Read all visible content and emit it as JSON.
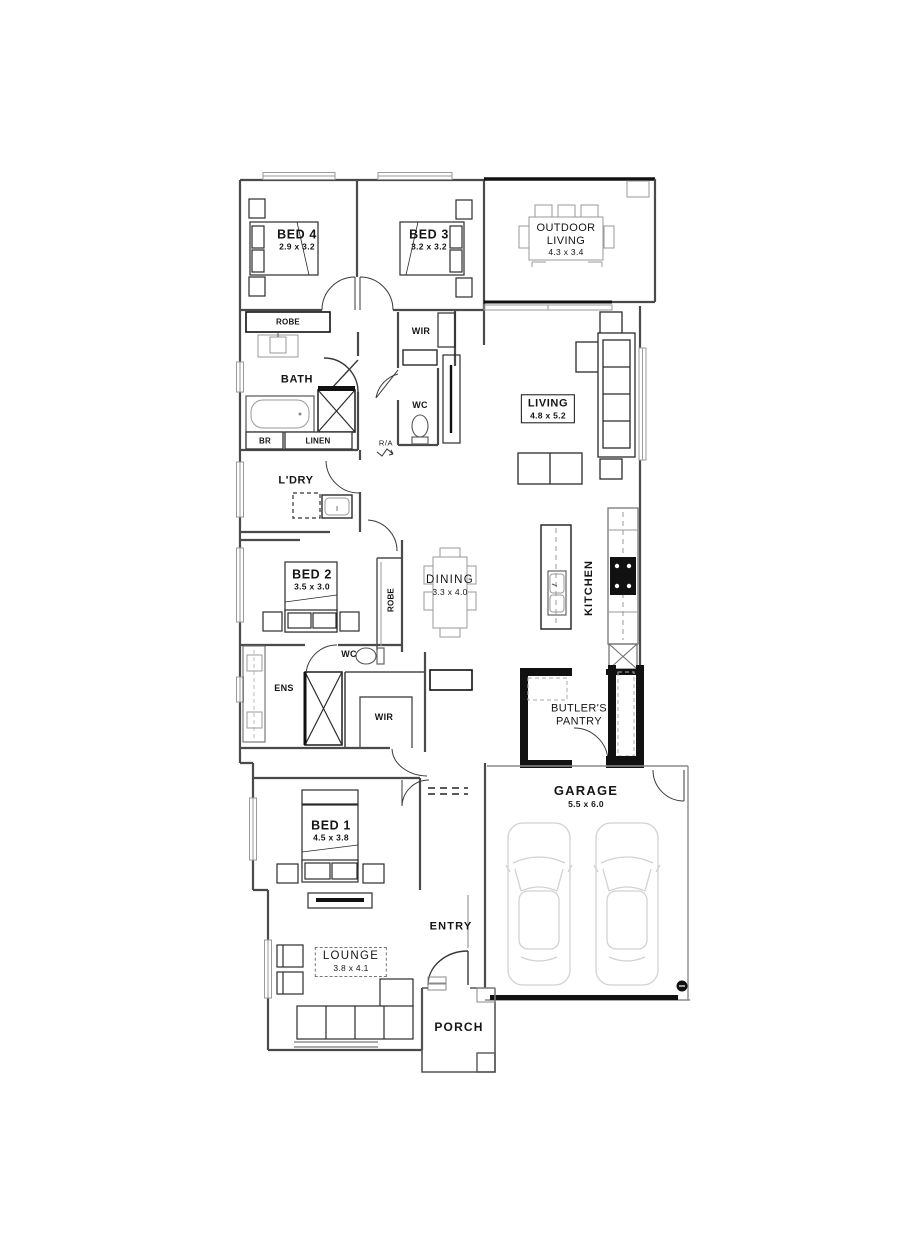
{
  "rooms": {
    "bed4": {
      "label": "BED 4",
      "dims": "2.9 x 3.2"
    },
    "bed3": {
      "label": "BED 3",
      "dims": "3.2 x 3.2"
    },
    "outdoor_living": {
      "label": "OUTDOOR LIVING",
      "dims": "4.3 x 3.4"
    },
    "robe_bed4": {
      "label": "ROBE"
    },
    "wir_hall": {
      "label": "WIR"
    },
    "bath": {
      "label": "BATH"
    },
    "wc_hall": {
      "label": "WC"
    },
    "br": {
      "label": "BR"
    },
    "linen": {
      "label": "LINEN"
    },
    "ra": {
      "label": "R/A"
    },
    "living": {
      "label": "LIVING",
      "dims": "4.8 x 5.2"
    },
    "ldry": {
      "label": "L'DRY"
    },
    "bed2": {
      "label": "BED 2",
      "dims": "3.5 x 3.0"
    },
    "robe_bed2": {
      "label": "ROBE"
    },
    "dining": {
      "label": "DINING",
      "dims": "3.3 x 4.0"
    },
    "kitchen": {
      "label": "KITCHEN"
    },
    "wc_ens": {
      "label": "WC"
    },
    "ens": {
      "label": "ENS"
    },
    "wir_master": {
      "label": "WIR"
    },
    "butlers_pantry": {
      "label": "BUTLER'S PANTRY"
    },
    "garage": {
      "label": "GARAGE",
      "dims": "5.5 x 6.0"
    },
    "bed1": {
      "label": "BED 1",
      "dims": "4.5 x 3.8"
    },
    "entry": {
      "label": "ENTRY"
    },
    "lounge": {
      "label": "LOUNGE",
      "dims": "3.8 x 4.1"
    },
    "porch": {
      "label": "PORCH"
    }
  },
  "colors": {
    "ink": "#151515",
    "wall": "#4a4a4a",
    "light_line": "#9a9a9a",
    "faint": "#cfcfcf"
  }
}
